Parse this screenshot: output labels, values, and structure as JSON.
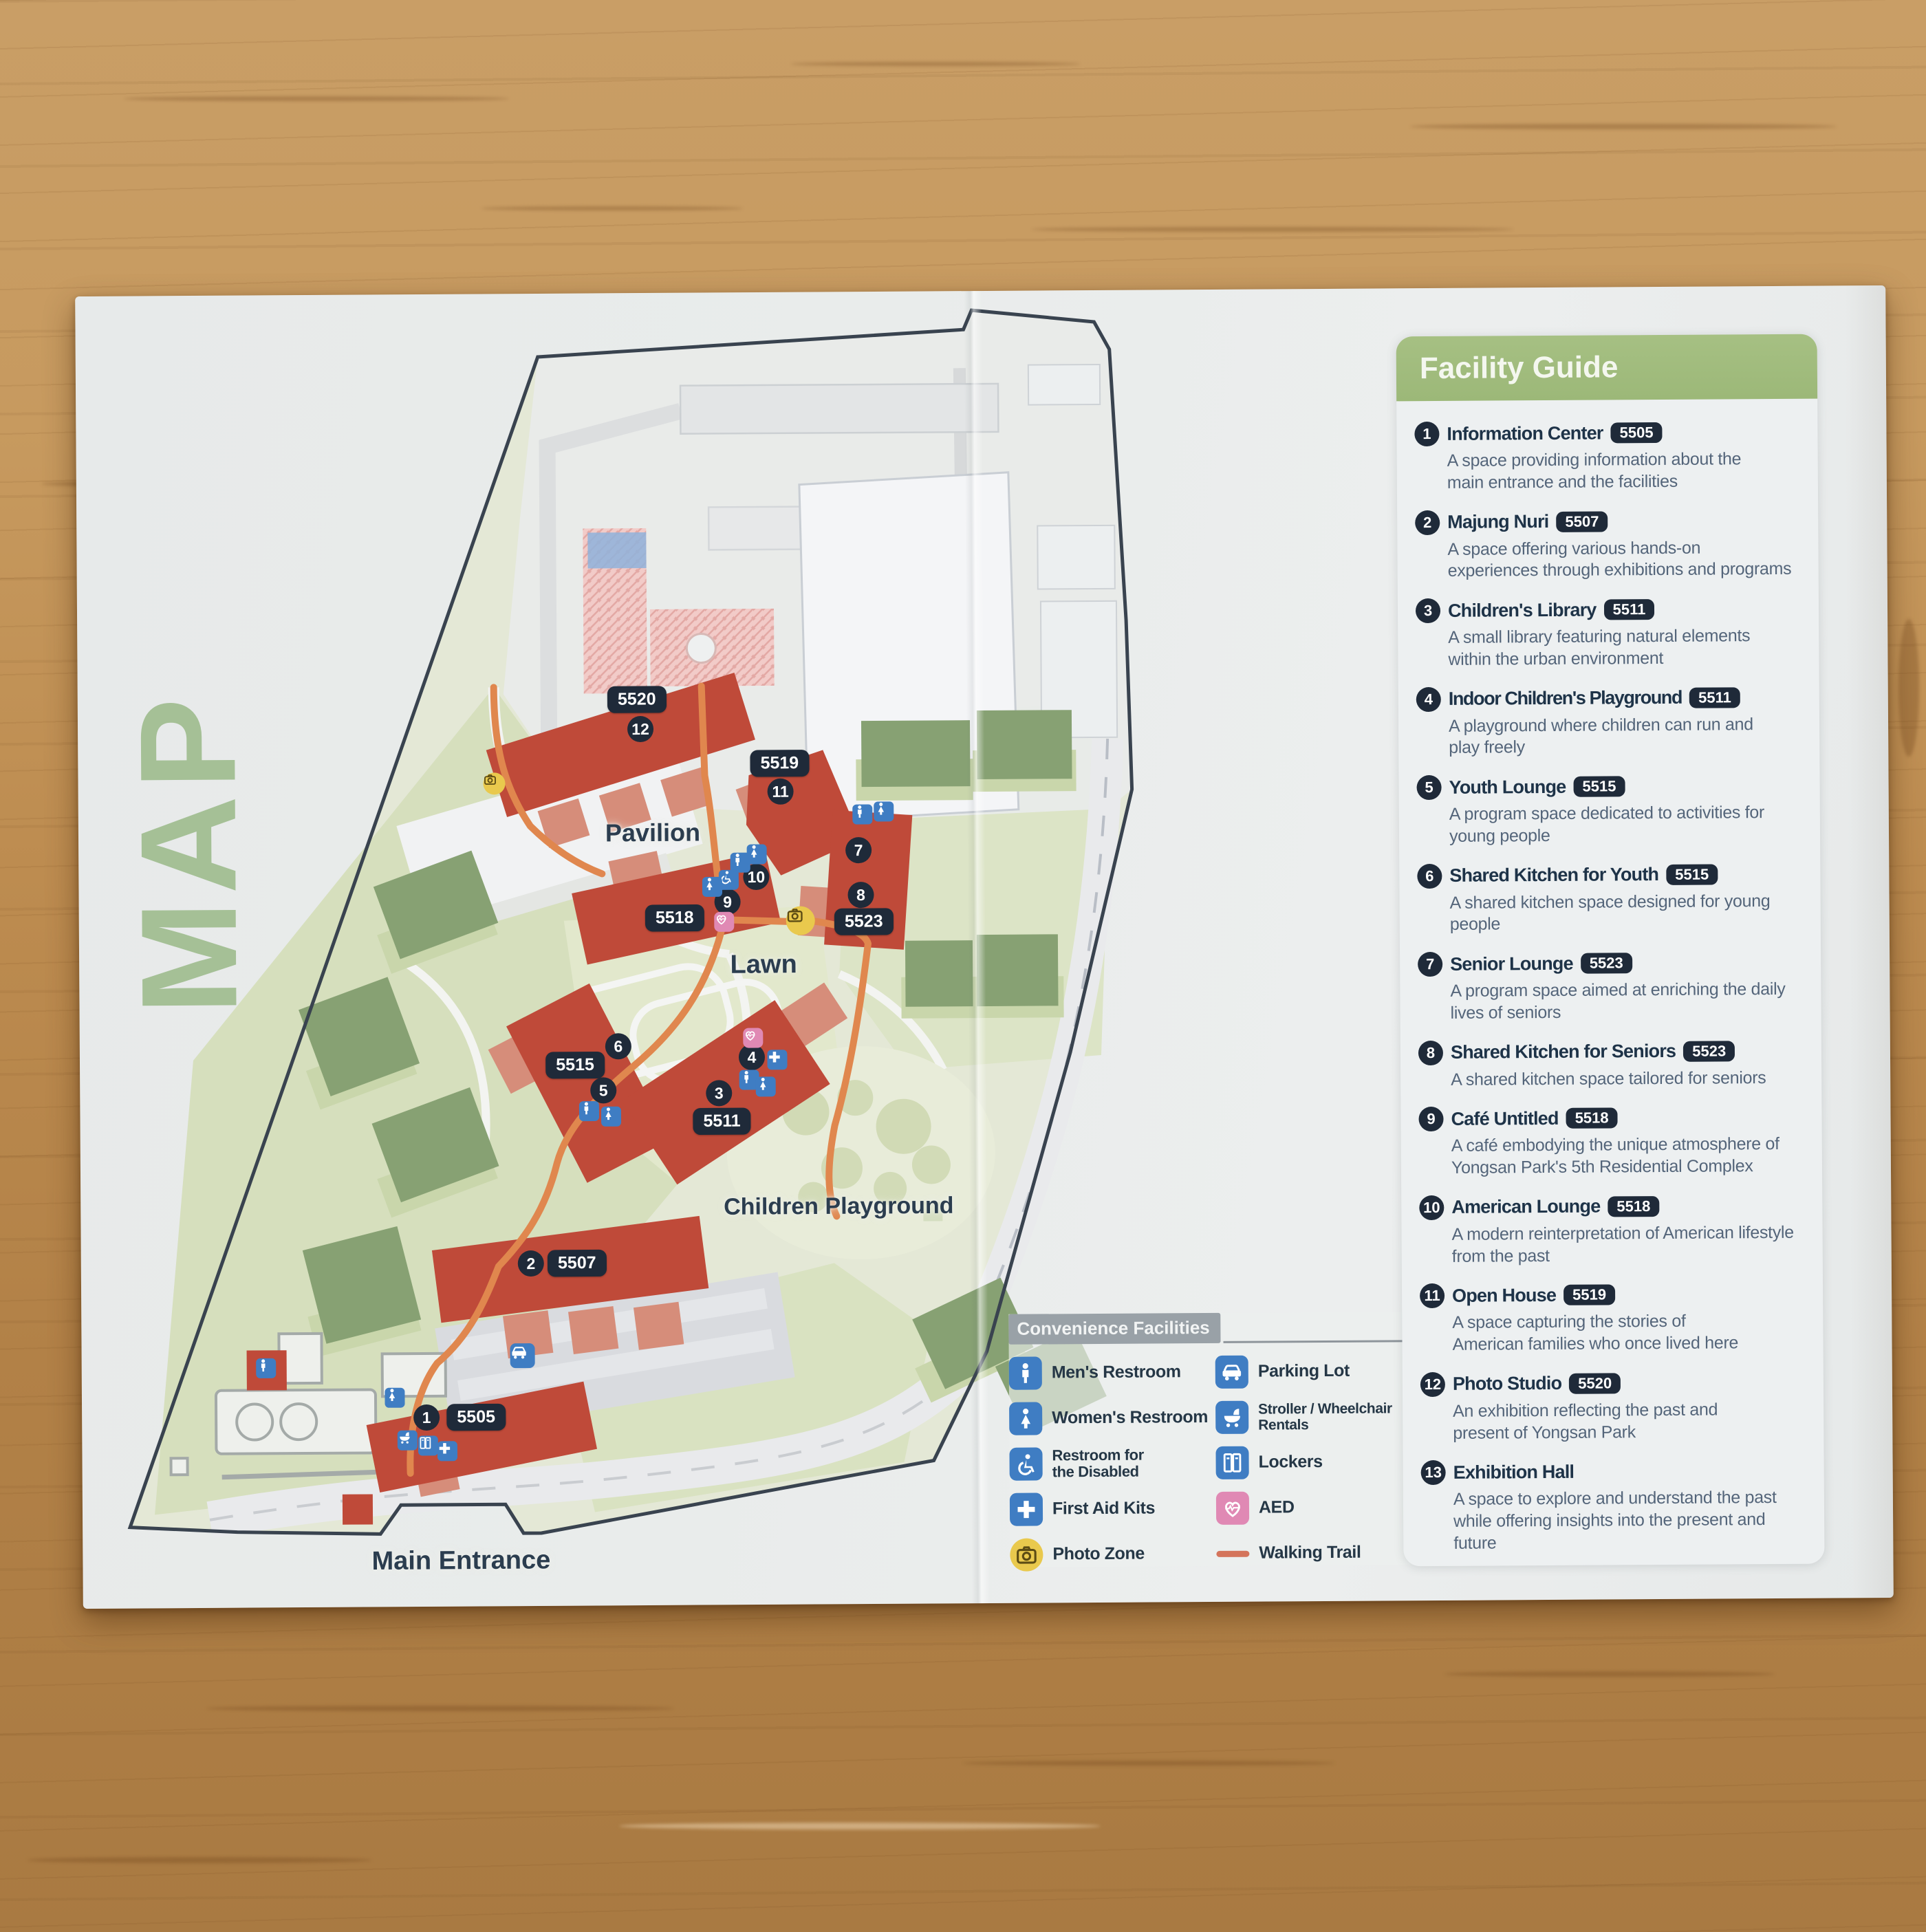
{
  "page": {
    "vertical_title": "MAP"
  },
  "facility_guide": {
    "title": "Facility Guide",
    "items": [
      {
        "num": "1",
        "name": "Information Center",
        "code": "5505",
        "desc": "A space providing information about the\nmain entrance and the facilities"
      },
      {
        "num": "2",
        "name": "Majung Nuri",
        "code": "5507",
        "desc": "A space offering various hands-on\nexperiences through exhibitions and programs"
      },
      {
        "num": "3",
        "name": "Children's Library",
        "code": "5511",
        "desc": "A small library featuring natural elements\nwithin the urban environment"
      },
      {
        "num": "4",
        "name": "Indoor Children's Playground",
        "code": "5511",
        "desc": "A playground where children can run and\nplay freely"
      },
      {
        "num": "5",
        "name": "Youth Lounge",
        "code": "5515",
        "desc": "A program space dedicated to activities for\nyoung people"
      },
      {
        "num": "6",
        "name": "Shared Kitchen for Youth",
        "code": "5515",
        "desc": "A shared kitchen space designed for young people"
      },
      {
        "num": "7",
        "name": "Senior Lounge",
        "code": "5523",
        "desc": "A program space aimed at enriching the daily\nlives of seniors"
      },
      {
        "num": "8",
        "name": "Shared Kitchen for Seniors",
        "code": "5523",
        "desc": "A shared kitchen space tailored for seniors"
      },
      {
        "num": "9",
        "name": "Café Untitled",
        "code": "5518",
        "desc": "A café embodying the unique atmosphere of\nYongsan Park's 5th Residential Complex"
      },
      {
        "num": "10",
        "name": "American Lounge",
        "code": "5518",
        "desc": "A modern reinterpretation of American lifestyle\nfrom the past"
      },
      {
        "num": "11",
        "name": "Open House",
        "code": "5519",
        "desc": "A space capturing the stories of\nAmerican families who once lived here"
      },
      {
        "num": "12",
        "name": "Photo Studio",
        "code": "5520",
        "desc": "An exhibition reflecting the past and\npresent of Yongsan Park"
      },
      {
        "num": "13",
        "name": "Exhibition Hall",
        "code": "",
        "desc": "A space to explore and understand the past\nwhile offering insights into the present and future"
      }
    ]
  },
  "legend": {
    "title": "Convenience Facilities",
    "items_left": [
      {
        "icon": "mens-restroom",
        "label": "Men's Restroom"
      },
      {
        "icon": "womens-restroom",
        "label": "Women's Restroom"
      },
      {
        "icon": "accessible-restroom",
        "label": "Restroom for\nthe Disabled"
      },
      {
        "icon": "first-aid",
        "label": "First Aid Kits"
      },
      {
        "icon": "photo-zone",
        "label": "Photo Zone"
      }
    ],
    "items_right": [
      {
        "icon": "parking",
        "label": "Parking Lot"
      },
      {
        "icon": "stroller",
        "label": "Stroller / Wheelchair\nRentals"
      },
      {
        "icon": "lockers",
        "label": "Lockers"
      },
      {
        "icon": "aed",
        "label": "AED"
      },
      {
        "icon": "walking-trail",
        "label": "Walking Trail"
      }
    ]
  },
  "map": {
    "area_labels": {
      "pavilion": "Pavilion",
      "lawn": "Lawn",
      "children_playground": "Children Playground",
      "main_entrance": "Main Entrance"
    },
    "markers": [
      {
        "code": "5505",
        "num": "1"
      },
      {
        "code": "5507",
        "num": "2"
      },
      {
        "code": "5511",
        "num_a": "3",
        "num_b": "4"
      },
      {
        "code": "5515",
        "num_a": "5",
        "num_b": "6"
      },
      {
        "code": "5523",
        "num_a": "7",
        "num_b": "8"
      },
      {
        "code": "5518",
        "num_a": "9",
        "num_b": "10"
      },
      {
        "code": "5519",
        "num": "11"
      },
      {
        "code": "5520",
        "num": "12"
      }
    ]
  },
  "colors": {
    "accent_green": "#a2bd80",
    "badge_navy": "#1f2a39",
    "building_red": "#bf4a39",
    "building_green": "#87a173",
    "trail_orange": "#e0874e",
    "icon_blue": "#3f7dc3",
    "aed_pink": "#e089b4",
    "photo_yellow": "#e9c94d"
  }
}
